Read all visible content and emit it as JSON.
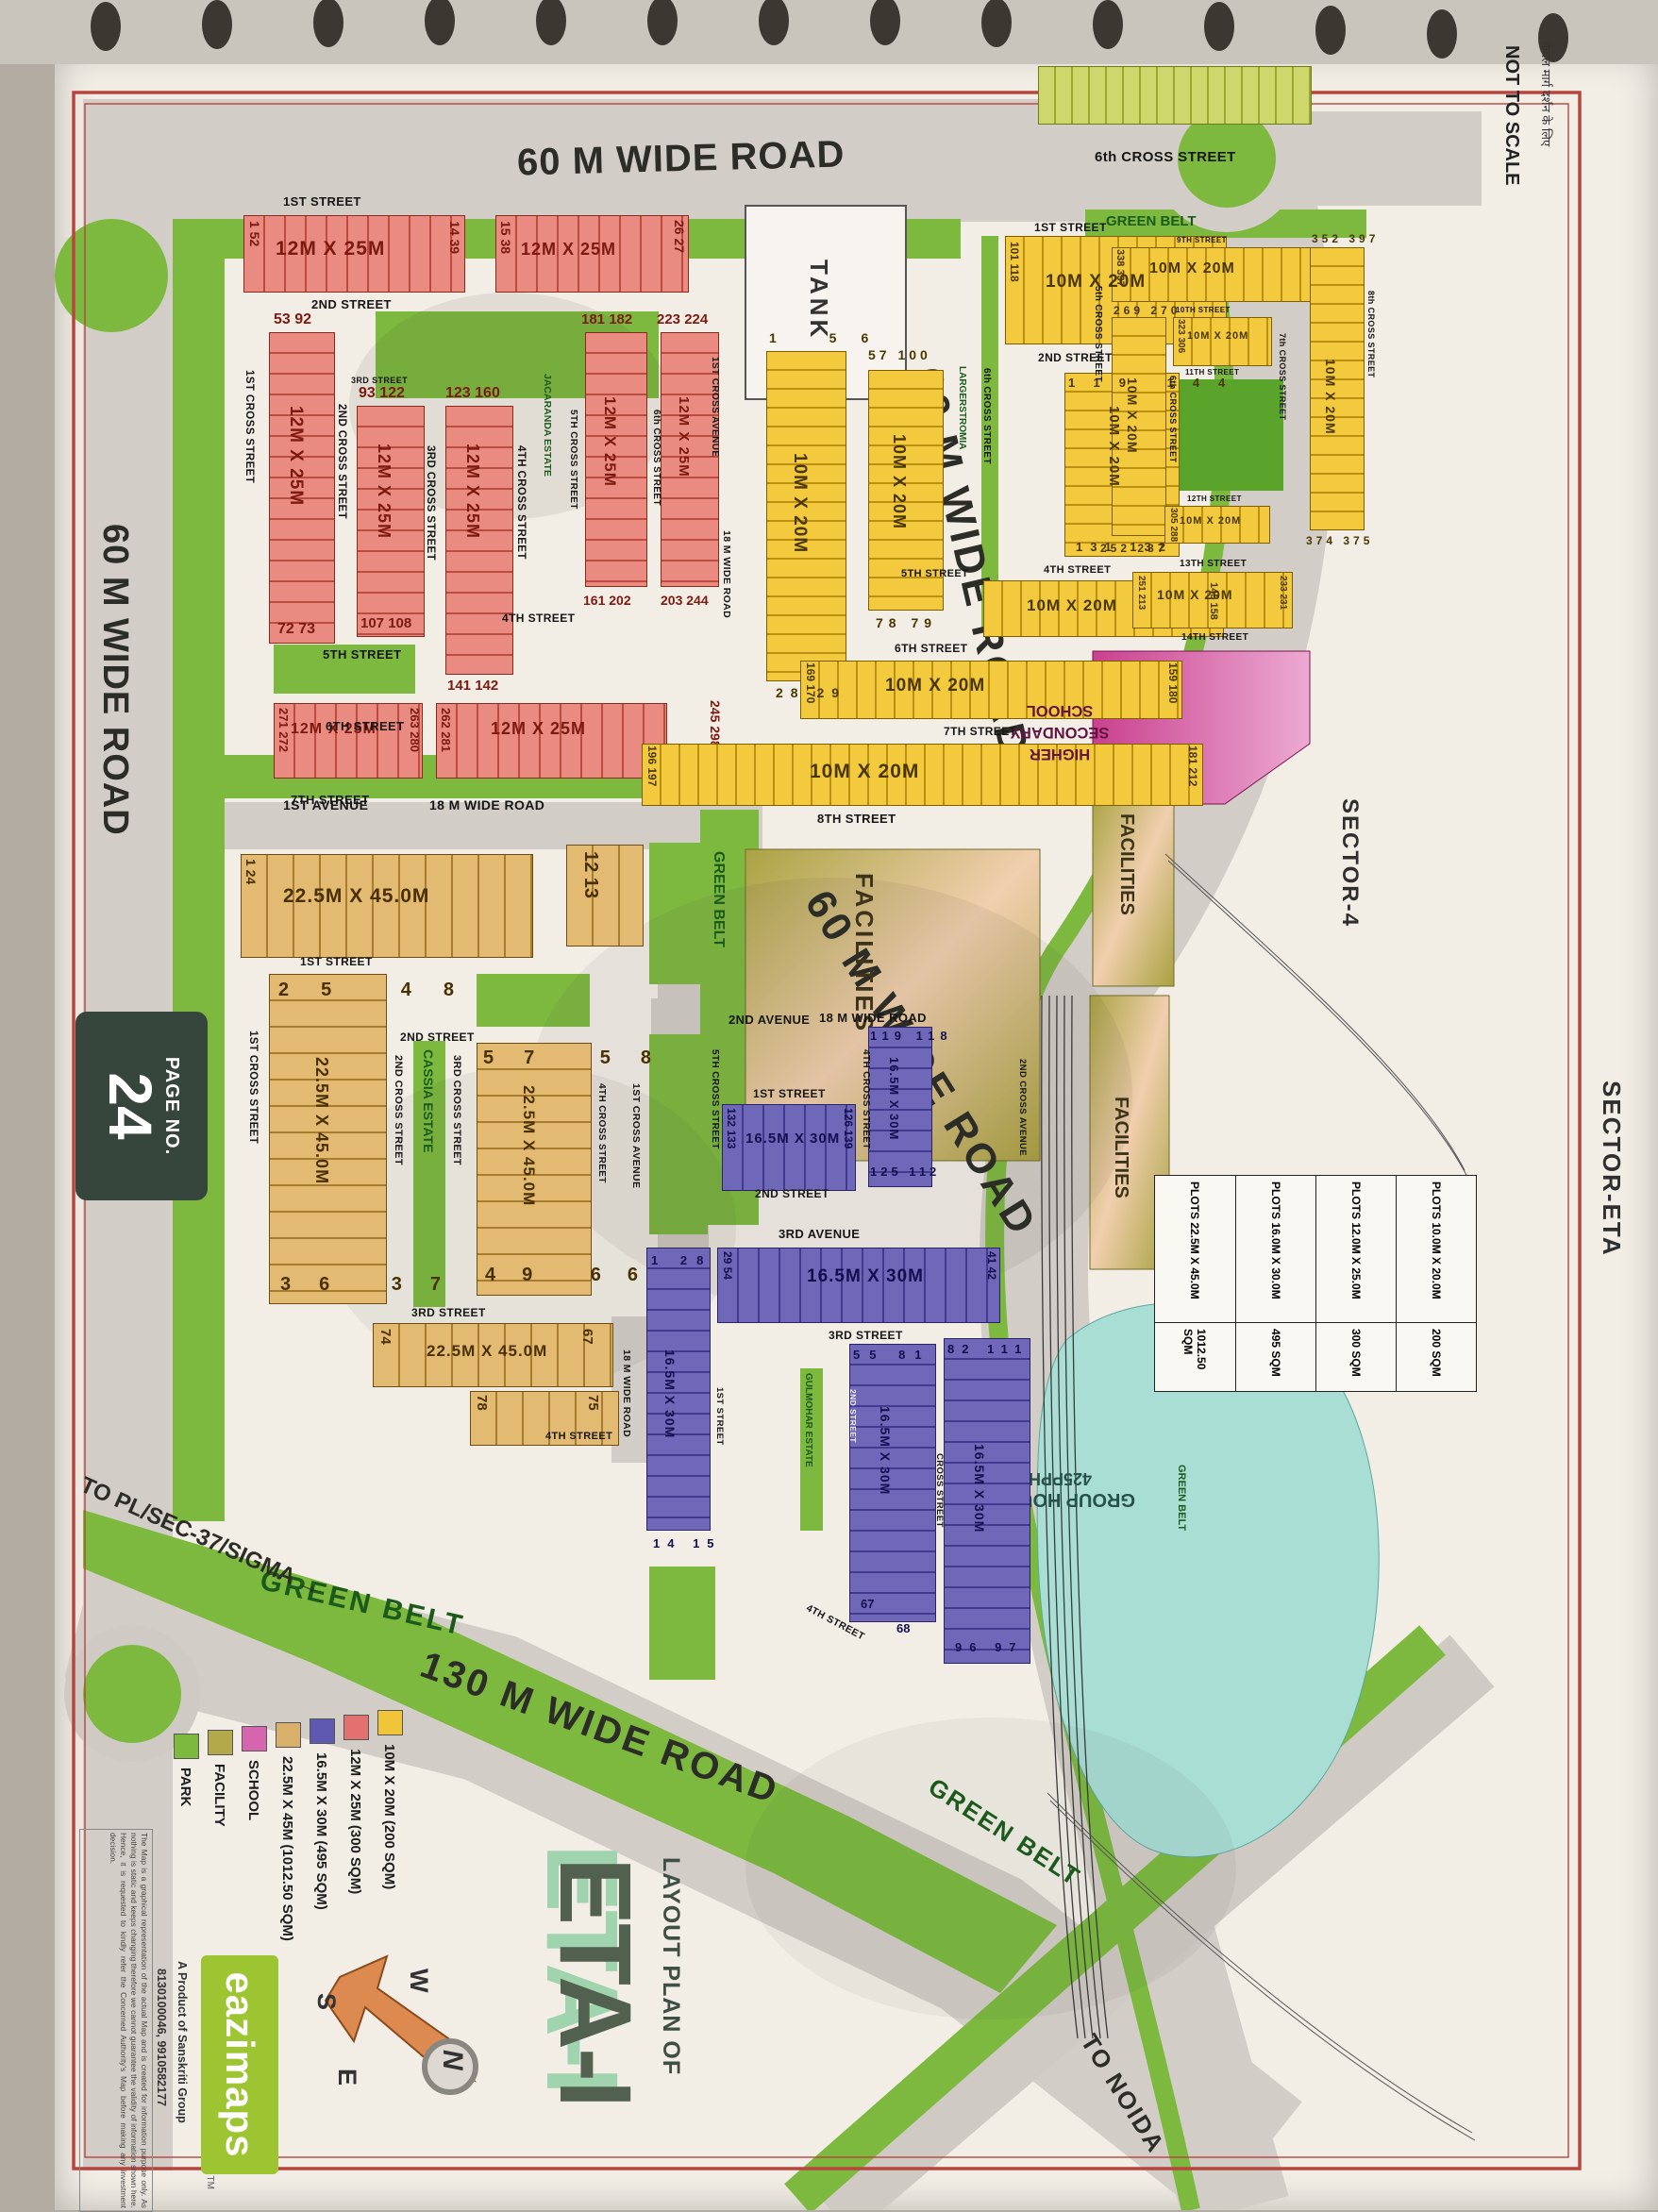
{
  "frame": {
    "not_to_scale": "NOT TO SCALE",
    "hindi_note": "केवल मार्ग दर्शन के लिए",
    "sector4": "SECTOR-4",
    "sector_eta": "SECTOR-ETA",
    "page_no_label": "PAGE NO.",
    "page_no": "24"
  },
  "roads": {
    "r60": "60 M WIDE ROAD",
    "r130": "130 M WIDE ROAD",
    "r18": "18 M WIDE ROAD",
    "green_belt": "GREEN BELT",
    "to_noida": "TO NOIDA",
    "to_sigma": "TO PL/SEC-37/SIGMA →",
    "tank": "TANK"
  },
  "streets": {
    "s1": "1ST STREET",
    "s2": "2ND STREET",
    "s3": "3RD STREET",
    "s4": "4TH STREET",
    "s5": "5TH STREET",
    "s6": "6TH STREET",
    "s7": "7TH STREET",
    "s8": "8TH STREET",
    "s9": "9TH STREET",
    "s10": "10TH STREET",
    "s11": "11TH STREET",
    "s12": "12TH STREET",
    "s13": "13TH STREET",
    "s14": "14TH STREET",
    "a1": "1ST AVENUE",
    "a2": "2ND AVENUE",
    "a3": "3RD AVENUE",
    "ca1": "1ST CROSS AVENUE",
    "ca2": "2ND CROSS AVENUE",
    "c1": "1ST CROSS STREET",
    "c2": "2ND CROSS STREET",
    "c3": "3RD CROSS STREET",
    "c4": "4TH CROSS STREET",
    "c5": "5TH CROSS STREET",
    "c6": "6th CROSS STREET",
    "c7": "7th CROSS STREET",
    "c8": "8th CROSS STREET",
    "c5l": "5th CROSS STREET",
    "cs": "CROSS STREET"
  },
  "dims": {
    "red": "12M X 25M",
    "yellow": "10M X 20M",
    "blue": "16.5M X 30M",
    "tan": "22.5M X 45.0M"
  },
  "estates": {
    "jacaranda": "JACARANDA ESTATE",
    "largerstromia": "LARGERSTROMIA",
    "cassia": "CASSIA ESTATE",
    "gulmohar": "GULMOHAR ESTATE"
  },
  "zones": {
    "school": "HIGHER SECONDARY SCHOOL",
    "facilities": "FACILITIES",
    "group_housing": "GROUP HOUSING",
    "group_housing_density": "425PPHA"
  },
  "plots": {
    "red": [
      "1 52",
      "14 39",
      "15 38",
      "26 27",
      "53 92",
      "72 73",
      "93 122",
      "107 108",
      "123 160",
      "141 142",
      "181 182",
      "161 202",
      "223 224",
      "203 244",
      "245 298",
      "271 272",
      "263 280",
      "262 281"
    ],
    "yellow": [
      "1 56",
      "28 29",
      "57 100",
      "78 79",
      "101 118",
      "119 144",
      "131 132",
      "145 158",
      "169 170",
      "159 180",
      "196 197",
      "181 212",
      "338 337",
      "352 397",
      "269 270",
      "252 287",
      "374 375",
      "305 288",
      "323 306",
      "251 213",
      "233 231"
    ],
    "blue": [
      "119 118",
      "132 133",
      "126 139",
      "125 112",
      "1 28",
      "29 54",
      "41 42",
      "55 81",
      "82 111",
      "14 15",
      "67",
      "68",
      "96 97"
    ],
    "tan": [
      "1 24",
      "12 13",
      "25 48",
      "36 37",
      "57 58",
      "49 66",
      "74",
      "67",
      "78",
      "75"
    ]
  },
  "legend": {
    "items": [
      {
        "label": "10M X 20M (200 SQM)",
        "color": "#f0c53a"
      },
      {
        "label": "12M X 25M (300 SQM)",
        "color": "#e2716f"
      },
      {
        "label": "16.5M X 30M (495 SQM)",
        "color": "#5f58b0"
      },
      {
        "label": "22.5M X 45M (1012.50 SQM)",
        "color": "#d8b06a"
      },
      {
        "label": "SCHOOL",
        "color": "#d565ae"
      },
      {
        "label": "FACILITY",
        "color": "#b2a94b"
      },
      {
        "label": "PARK",
        "color": "#7cb93e"
      }
    ]
  },
  "table": {
    "rows": [
      {
        "label": "PLOTS 10.0M X 20.0M",
        "value": "200 SQM"
      },
      {
        "label": "PLOTS 12.0M X 25.0M",
        "value": "300 SQM"
      },
      {
        "label": "PLOTS 16.0M X 30.0M",
        "value": "495 SQM"
      },
      {
        "label": "PLOTS 22.5M X 45.0M",
        "value": "1012.50 SQM"
      }
    ]
  },
  "title": {
    "line1": "LAYOUT PLAN OF",
    "line2": "ETA-I"
  },
  "branding": {
    "logo": "eazimaps",
    "tm": "TM",
    "product": "A Product of Sanskriti Group",
    "phone": "8130100046, 9910582177"
  },
  "disclaimer": "The Map is a graphical representation of the actual Map and is created for information purpose only. As nothing is static and keeps changing therefore we cannot guarantee the validity of information shown here. Hence, it is requested to kindly refer the Concerned Authority's Map before making any investment decision.",
  "compass": {
    "n": "N",
    "s": "S",
    "e": "E",
    "w": "W"
  }
}
